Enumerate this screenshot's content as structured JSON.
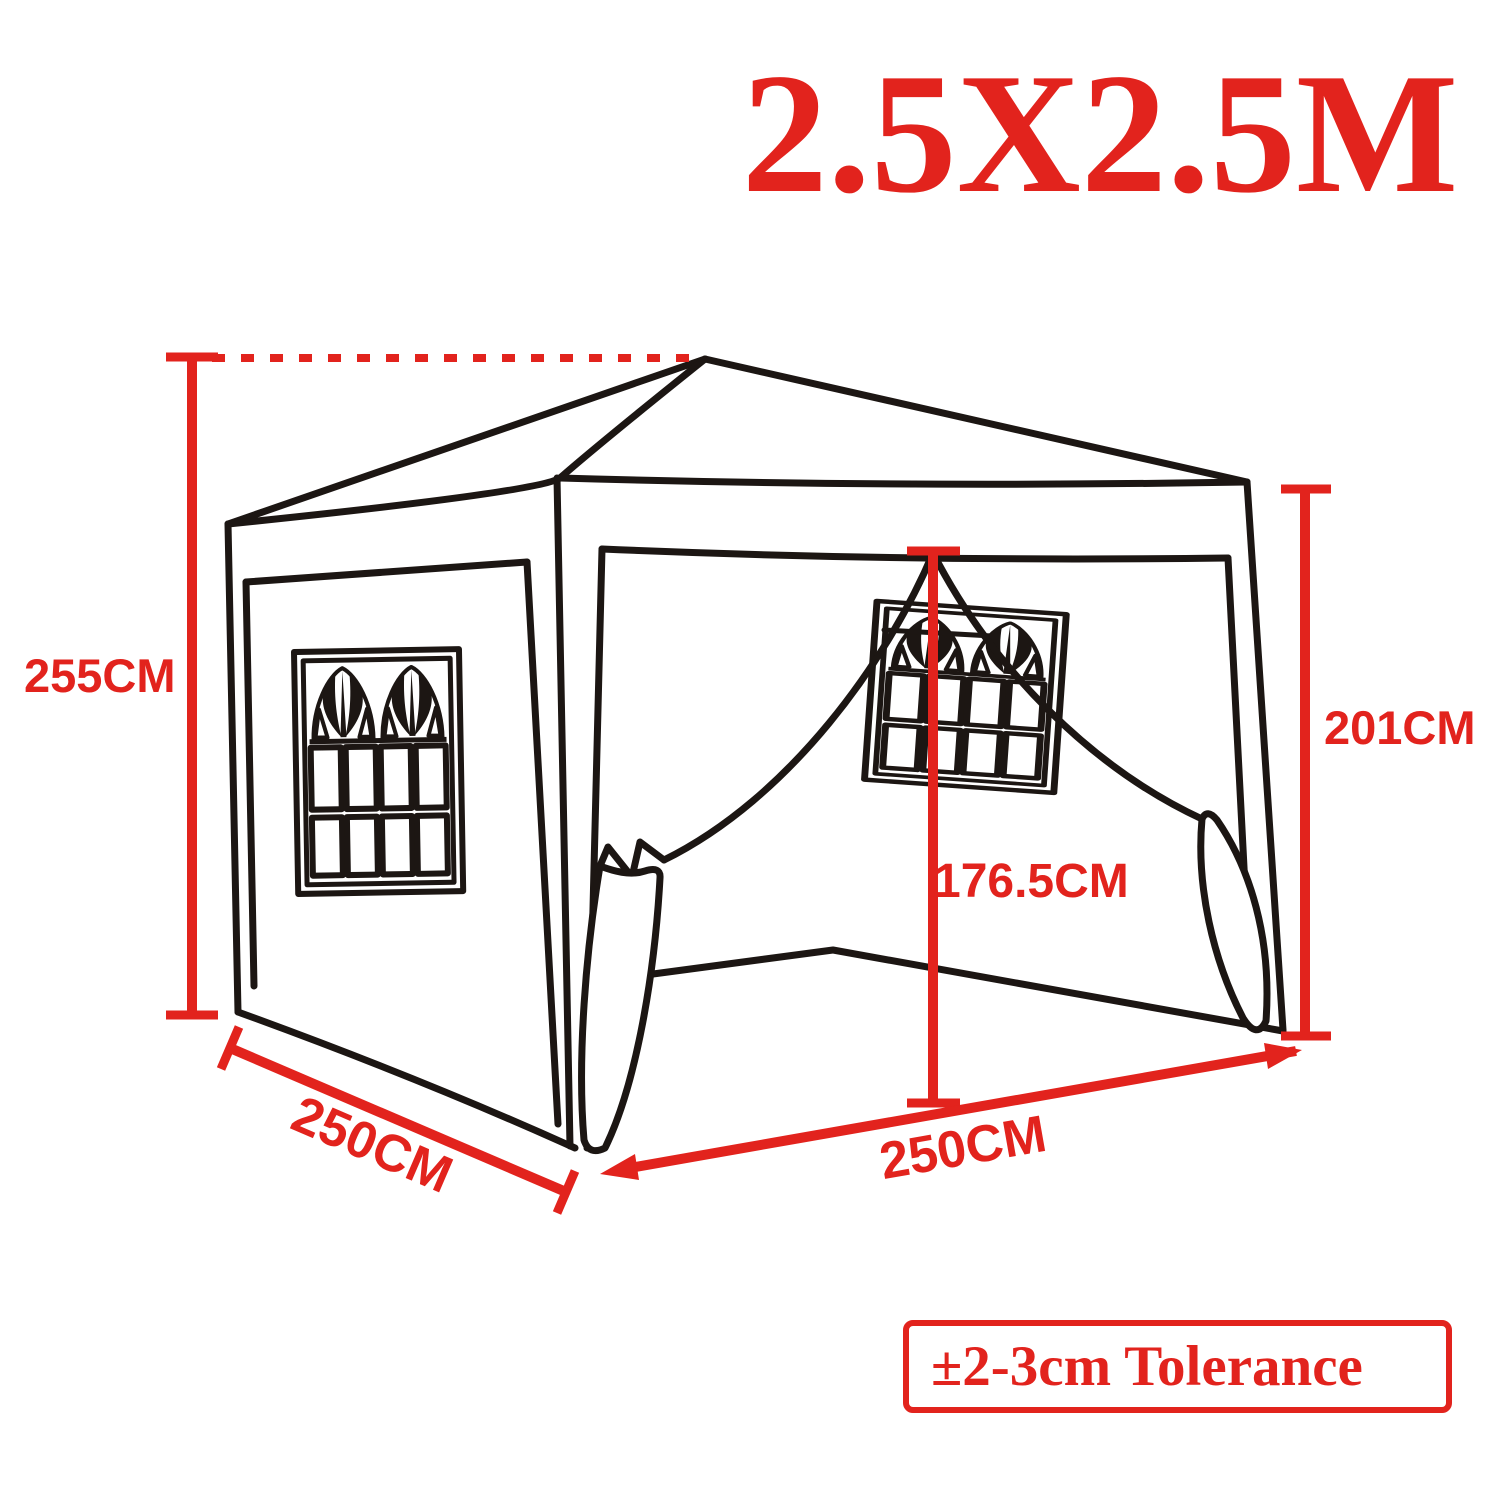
{
  "title": "2.5X2.5M",
  "tolerance_note": "±2-3cm Tolerance",
  "dimensions": {
    "overall_height": {
      "label": "255CM"
    },
    "wall_height": {
      "label": "201CM"
    },
    "door_height": {
      "label": "176.5CM"
    },
    "side_depth": {
      "label": "250CM"
    },
    "front_width": {
      "label": "250CM"
    }
  },
  "colors": {
    "dimension_red": "#e2231d",
    "outline_black": "#1c1613",
    "background": "#ffffff"
  }
}
